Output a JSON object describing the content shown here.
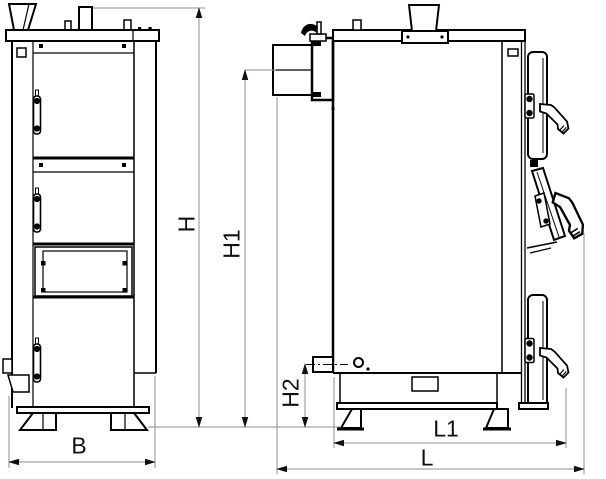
{
  "drawing": {
    "views": {
      "front_view": "boiler front elevation with three doors",
      "side_view": "boiler side elevation with flue outlet and open middle door"
    },
    "dimension_labels": {
      "overall_height": "H",
      "flue_axis_height": "H1",
      "drain_axis_height": "H2",
      "overall_width": "B",
      "base_length": "L1",
      "overall_length": "L"
    },
    "colors": {
      "line": "#000000",
      "dimension_line": "#8f8f8f",
      "arrow": "#111111",
      "background": "#ffffff"
    }
  }
}
